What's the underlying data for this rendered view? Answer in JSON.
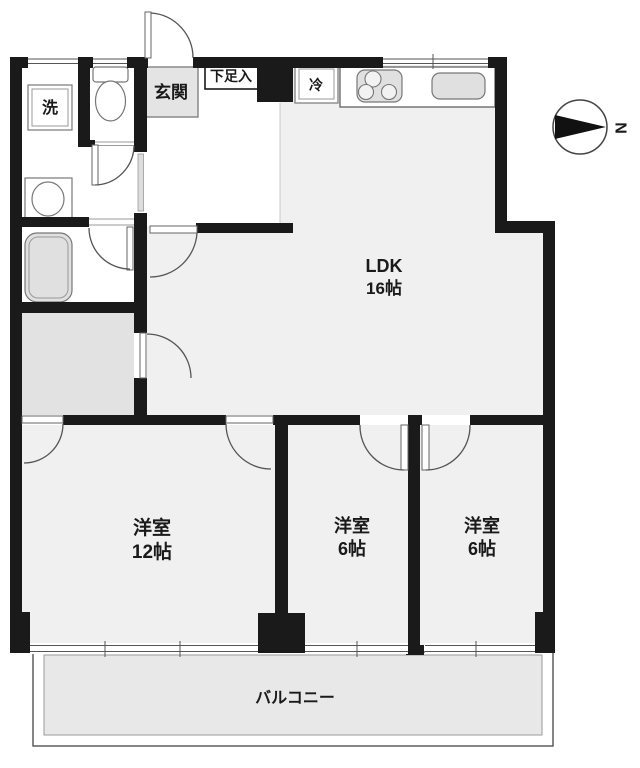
{
  "floor_plan": {
    "rooms": {
      "ldk": {
        "label": "LDK",
        "size": "16帖"
      },
      "bedroom1": {
        "label": "洋室",
        "size": "12帖"
      },
      "bedroom2": {
        "label": "洋室",
        "size": "6帖"
      },
      "bedroom3": {
        "label": "洋室",
        "size": "6帖"
      },
      "balcony": {
        "label": "バルコニー"
      },
      "entrance": {
        "label": "玄関"
      },
      "shoe_storage": {
        "label": "下足入"
      },
      "laundry": {
        "label": "洗"
      },
      "refrigerator": {
        "label": "冷"
      }
    },
    "compass": {
      "north_label": "N"
    },
    "colors": {
      "wall": "#1a1a1a",
      "room_fill": "#f0f0f0",
      "closet_fill": "#e2e2e2",
      "balcony_fill": "#e8e8e8",
      "entrance_fill": "#e4e4e4",
      "fixture_fill": "#e0e0e0",
      "line": "#555555"
    }
  }
}
